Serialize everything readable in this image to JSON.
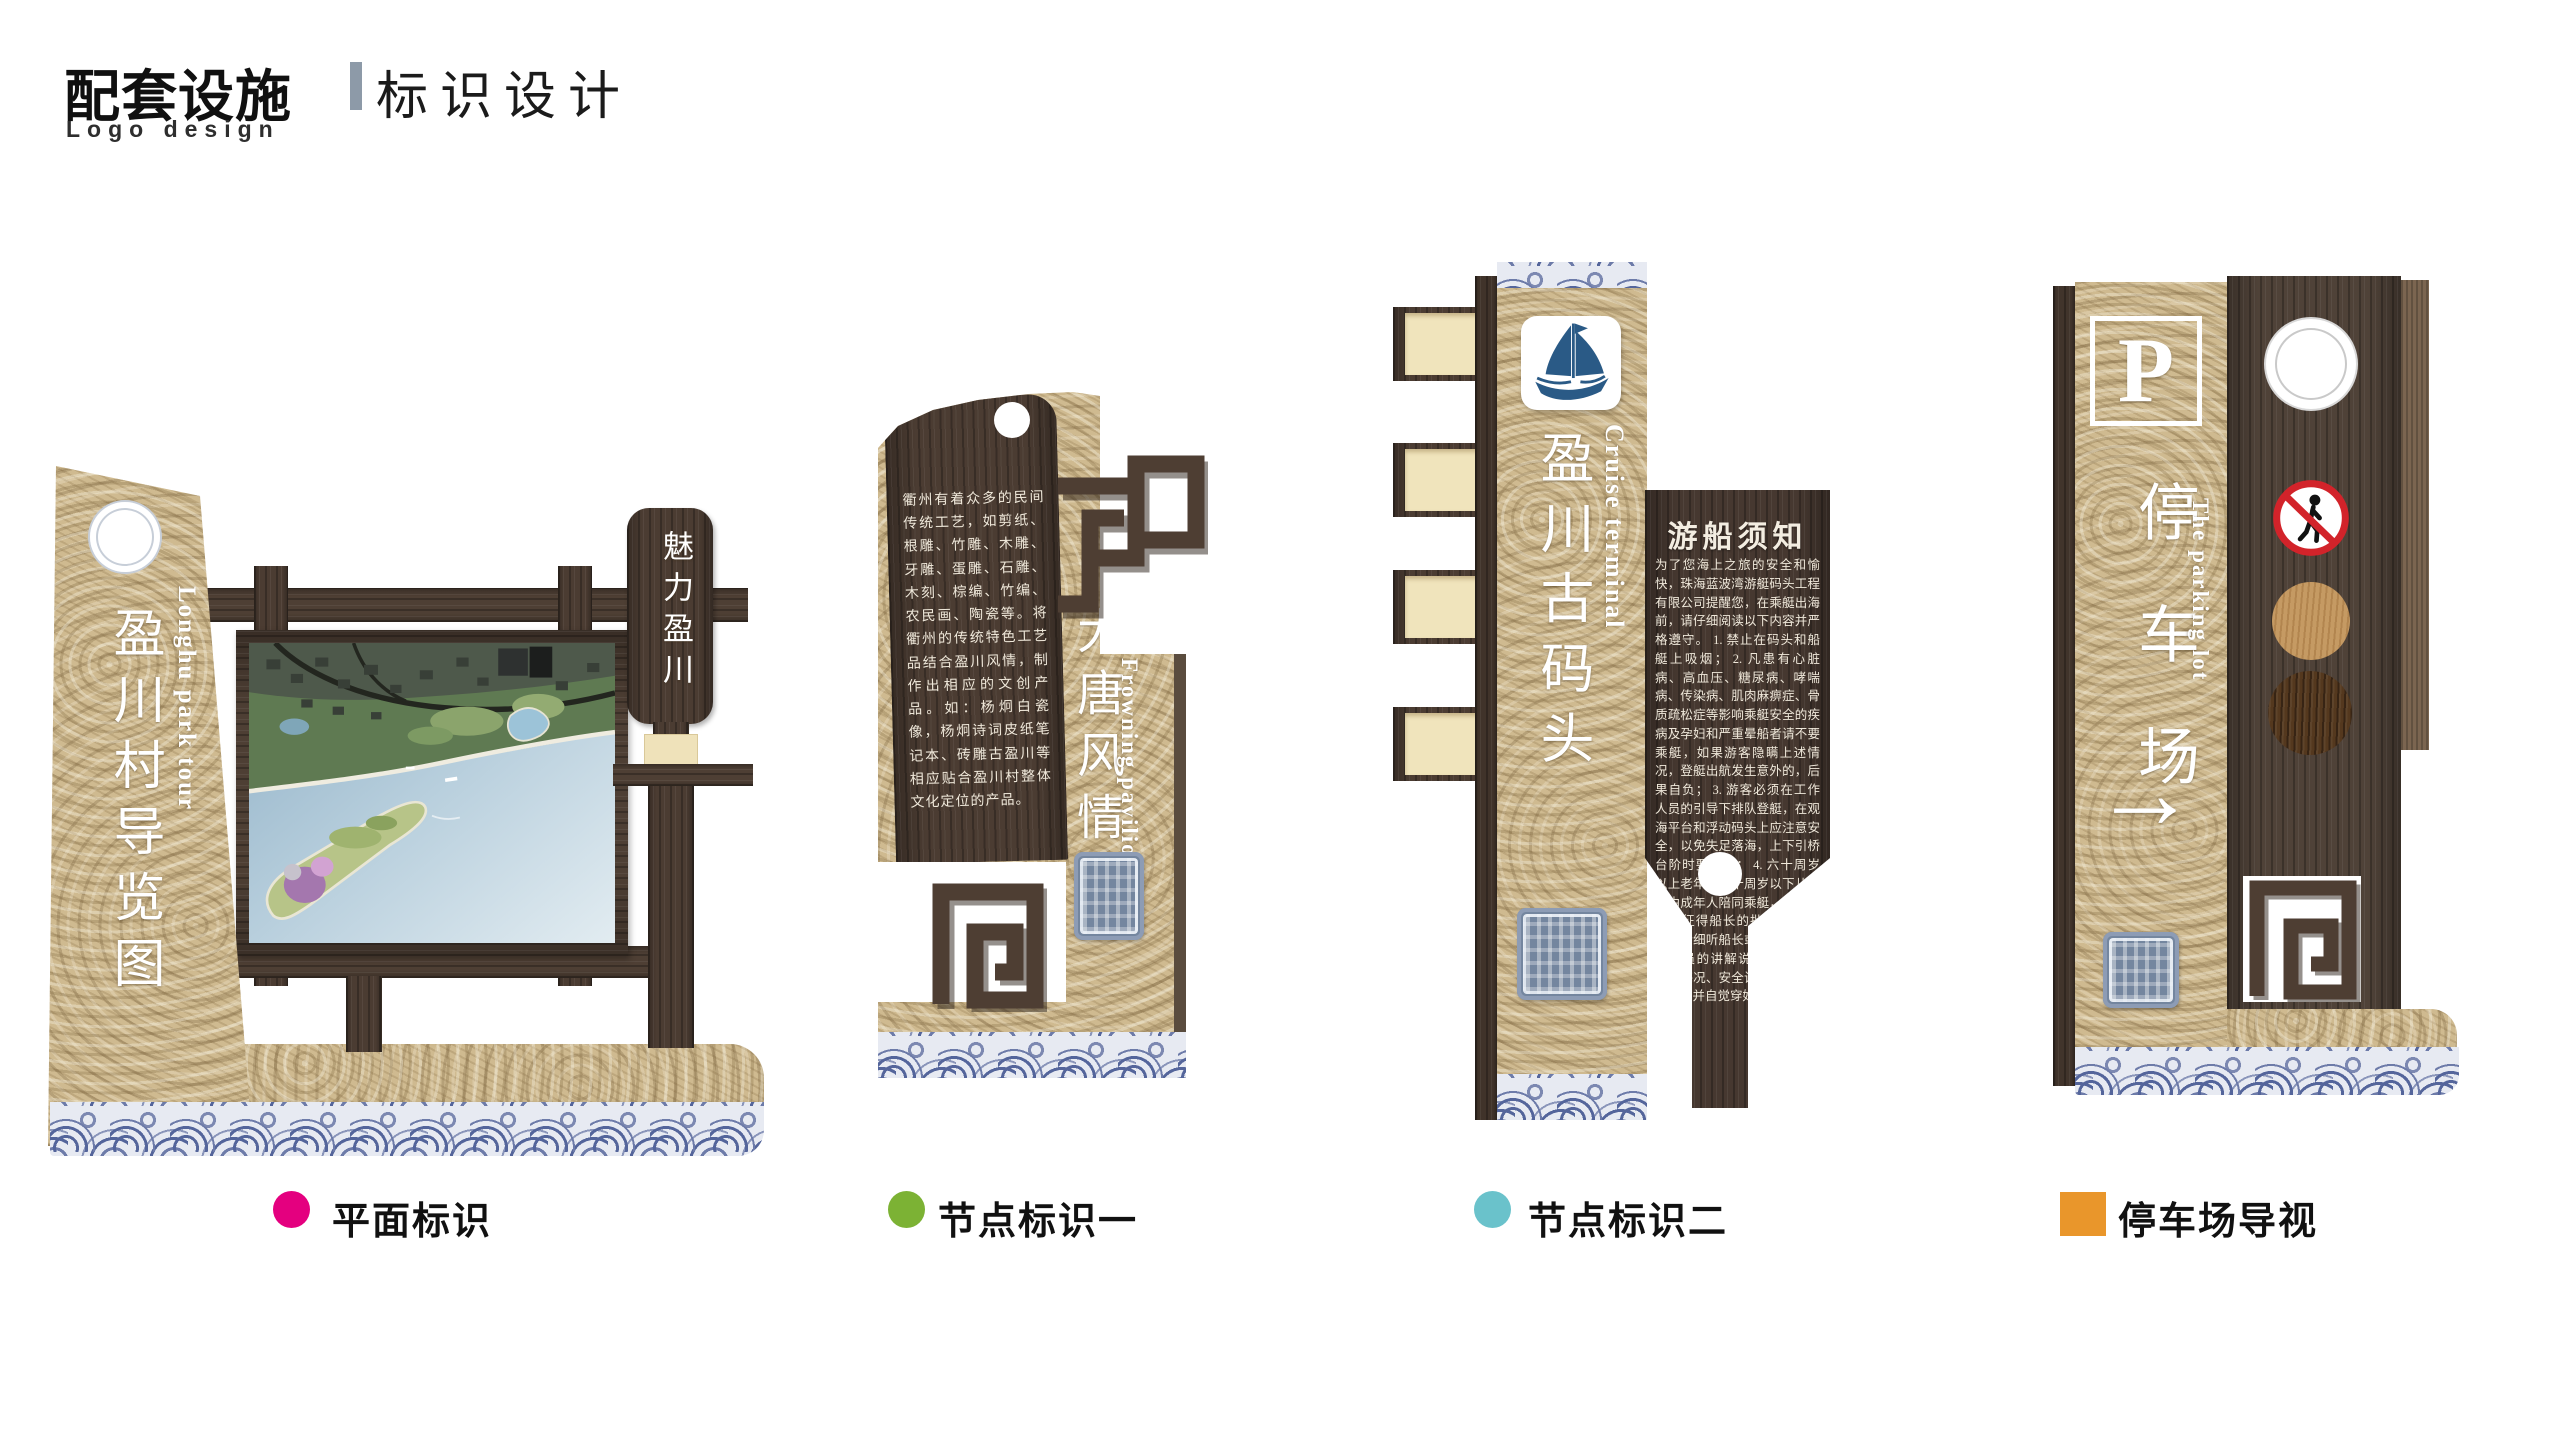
{
  "header": {
    "title_primary": "配套设施",
    "title_secondary": "标识设计",
    "subtitle": "Logo design"
  },
  "signs": {
    "map_sign": {
      "pillar_title": "盈川村导览图",
      "pillar_subtitle_en": "Longhu park tour",
      "plaque": "魅力盈川"
    },
    "node_sign_1": {
      "intro_text": "衢州有着众多的民间传统工艺，如剪纸、根雕、竹雕、木雕、牙雕、蛋雕、石雕、木刻、棕编、竹编、农民画、陶瓷等。将衢州的传统特色工艺品结合盈川风情，制作出相应的文创产品。如：杨炯白瓷像，杨炯诗词皮纸笔记本、砖雕古盈川等相应贴合盈川村整体文化定位的产品。",
      "title": "大唐风情街",
      "title_en": "Frowning pavilion"
    },
    "node_sign_2": {
      "title": "盈川古码头",
      "title_en": "Cruise terminal",
      "notice_title": "游船须知",
      "notice_body": "为了您海上之旅的安全和愉快，珠海蓝波湾游艇码头工程有限公司提醒您，在乘艇出海前，请仔细阅读以下内容并严格遵守。 1. 禁止在码头和船艇上吸烟； 2. 凡患有心脏病、高血压、糖尿病、哮喘病、传染病、肌肉麻痹症、骨质疏松症等影响乘艇安全的疾病及孕妇和严重晕船者请不要乘艇，如果游客隐瞒上述情况，登艇出航发生意外的，后果自负； 3. 游客必须在工作人员的引导下排队登艇，在观海平台和浮动码头上应注意安全，以免失足落海，上下引桥台阶时要小心； 4. 六十周岁以上老年人和十周岁以下儿童应由成年人陪同乘艇，出海前还须征得船长的批准； 5. 上船后请细听船长或其他船上工作人员的讲解说明，包括行程、海况、安全设施的使用方法等，并自觉穿好救生衣；"
    },
    "parking_sign": {
      "p_symbol": "P",
      "title": "停车场",
      "title_en": "The parking lot",
      "arrow": "→"
    }
  },
  "legend": {
    "items": [
      {
        "label": "平面标识",
        "color": "#e4007f",
        "shape": "circle"
      },
      {
        "label": "节点标识一",
        "color": "#7cb234",
        "shape": "circle"
      },
      {
        "label": "节点标识二",
        "color": "#6ac2cb",
        "shape": "circle"
      },
      {
        "label": "停车场导视",
        "color": "#e9962b",
        "shape": "square"
      }
    ]
  },
  "icons": {
    "sailboat": "sailboat-icon",
    "no_pedestrian": "no-pedestrian-icon",
    "seal_stamp": "seal-stamp-icon",
    "fret_pattern": "fret-pattern-icon",
    "wave_band": "wave-pattern"
  },
  "colors": {
    "rope": "#cfba90",
    "dark_wood": "#4b3c32",
    "wave_blue": "#54659b",
    "title_separator": "#8d9aa8",
    "legend_magenta": "#e4007f",
    "legend_green": "#7cb234",
    "legend_cyan": "#6ac2cb",
    "legend_orange": "#e9962b"
  }
}
